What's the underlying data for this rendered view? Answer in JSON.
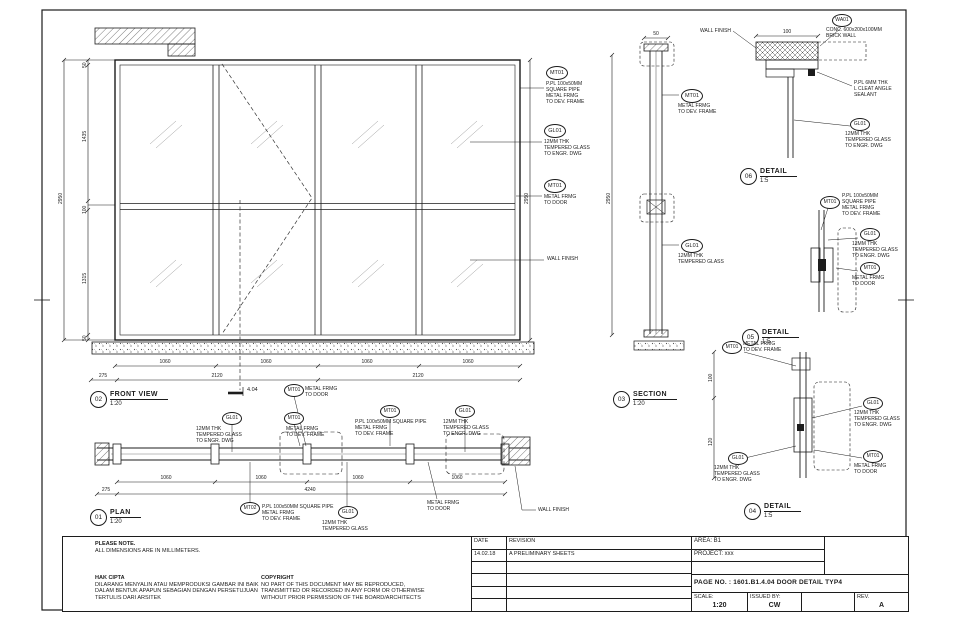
{
  "sheet": {
    "notes": {
      "title": "PLEASE NOTE.",
      "line": "ALL DIMENSIONS ARE IN MILLIMETERS."
    },
    "hak_cipta": {
      "title": "HAK CIPTA",
      "l": [
        "DILARANG MENYALIN ATAU MEMPRODUKSI GAMBAR INI BAIK",
        "DALAM BENTUK APAPUN SEBAGIAN DENGAN PERSETUJUAN",
        "TERTULIS DARI ARSITEK"
      ]
    },
    "copyright": {
      "title": "COPYRIGHT",
      "l": [
        "NO PART OF THIS DOCUMENT MAY BE REPRODUCED,",
        "TRANSMITTED OR RECORDED IN ANY FORM OR OTHERWISE",
        "WITHOUT PRIOR PERMISSION OF THE BOARD/ARCHITECTS"
      ]
    },
    "title_block": {
      "date_label": "DATE",
      "revision_label": "REVISION",
      "date": "14.02.18",
      "revision": "A    PRELIMINARY SHEETS",
      "area": "AREA: B1",
      "project": "PROJECT: xxx",
      "page_label": "PAGE NO. :",
      "page_value": "1601.B1.4.04 DOOR DETAIL TYP4",
      "scale_label": "SCALE:",
      "scale": "1:20",
      "issued_label": "ISSUED BY:",
      "issued": "CW",
      "rev_label": "REV.",
      "rev": "A"
    }
  },
  "views": {
    "front": {
      "no": "02",
      "name": "FRONT VIEW",
      "scale": "1:20"
    },
    "plan": {
      "no": "01",
      "name": "PLAN",
      "scale": "1:20"
    },
    "section": {
      "no": "03",
      "name": "SECTION",
      "scale": "1:20"
    },
    "d06": {
      "no": "06",
      "name": "DETAIL",
      "scale": "1:5"
    },
    "d05": {
      "no": "05",
      "name": "DETAIL",
      "scale": "1:5"
    },
    "d04": {
      "no": "04",
      "name": "DETAIL",
      "scale": "1:5"
    }
  },
  "a": {
    "fv1": {
      "id": "MT01",
      "l": [
        "P.PL 100x50MM",
        "SQUARE PIPE",
        "METAL FRMG",
        "TO DEV. FRAME"
      ]
    },
    "fv2": {
      "id": "GL01",
      "l": [
        "12MM THK",
        "TEMPERED GLASS",
        "TO ENGR. DWG"
      ]
    },
    "fv3": {
      "id": "MT01",
      "l": [
        "METAL FRMG",
        "TO DOOR"
      ]
    },
    "fv4": {
      "t": "WALL FINISH"
    },
    "sec1": {
      "id": "MT01",
      "l": [
        "METAL FRMG",
        "TO DEV. FRAME"
      ]
    },
    "sec2": {
      "id": "GL01",
      "l": [
        "12MM THK",
        "TEMPERED GLASS"
      ]
    },
    "pa1": {
      "id": "GL01",
      "l": [
        "12MM THK",
        "TEMPERED GLASS",
        "TO ENGR. DWG"
      ]
    },
    "pa2": {
      "id": "MT01",
      "l": [
        "METAL FRMG",
        "TO DOOR"
      ]
    },
    "pa3": {
      "id": "MT01",
      "l": [
        "METAL FRMG",
        "TO DEV. FRAME"
      ]
    },
    "pa4": {
      "id": "MT01",
      "l": [
        "P.PL 100x50MM SQUARE PIPE",
        "METAL FRMG",
        "TO DEV. FRAME"
      ]
    },
    "pa5": {
      "id": "GL01",
      "l": [
        "12MM THK",
        "TEMPERED GLASS",
        "TO ENGR. DWG"
      ]
    },
    "pb1": {
      "id": "MT02",
      "l": [
        "P.PL 100x50MM SQUARE PIPE",
        "METAL FRMG",
        "TO DEV. FRAME"
      ]
    },
    "pb2": {
      "id": "GL01",
      "l": [
        "12MM THK",
        "TEMPERED GLASS"
      ]
    },
    "pb3": {
      "t": "WALL FINISH"
    },
    "pb4": {
      "l": [
        "METAL FRMG",
        "TO DOOR"
      ]
    },
    "d61": {
      "t": "WALL FINISH"
    },
    "d62": {
      "id": "WA01",
      "l": [
        "CONC. 600x200x100MM",
        "BRICK WALL"
      ]
    },
    "d63": {
      "l": [
        "P.PL 6MM THK",
        "L CLEAT ANGLE",
        "SEALANT"
      ]
    },
    "d64": {
      "id": "GL01",
      "l": [
        "12MM THK",
        "TEMPERED GLASS",
        "TO ENGR. DWG"
      ]
    },
    "d51": {
      "id": "MT01",
      "l": [
        "P.PL 100x50MM",
        "SQUARE PIPE",
        "METAL FRMG",
        "TO DEV. FRAME"
      ]
    },
    "d52": {
      "id": "GL01",
      "l": [
        "12MM THK",
        "TEMPERED GLASS",
        "TO ENGR. DWG"
      ]
    },
    "d53": {
      "id": "MT01",
      "l": [
        "METAL FRMG",
        "TO DOOR"
      ]
    },
    "d41": {
      "id": "MT01",
      "l": [
        "METAL FRMG",
        "TO DEV. FRAME"
      ]
    },
    "d42": {
      "id": "GL01",
      "l": [
        "12MM THK",
        "TEMPERED GLASS",
        "TO ENGR. DWG"
      ]
    },
    "d43": {
      "id": "GL01",
      "l": [
        "12MM THK",
        "TEMPERED GLASS",
        "TO ENGR. DWG"
      ]
    },
    "d44": {
      "id": "MT01",
      "l": [
        "METAL FRMG",
        "TO DOOR"
      ]
    }
  },
  "dims": {
    "front_left_overall": "2950",
    "front_left_segs": [
      "50",
      "1435",
      "100",
      "1315",
      "50"
    ],
    "front_right_overall": "2950",
    "front_bottom_row1": [
      "1060",
      "1060",
      "1060",
      "1060"
    ],
    "front_bottom_row2": [
      "275",
      "2120",
      "2120"
    ],
    "section_overall": "2950",
    "section_top": "50",
    "plan_row1": [
      "1060",
      "1060",
      "1060",
      "1060"
    ],
    "plan_row2": [
      "275",
      "4240"
    ],
    "d6_top": "100",
    "d4_segs": [
      "100",
      "120"
    ],
    "ref_mark": "4.04"
  }
}
